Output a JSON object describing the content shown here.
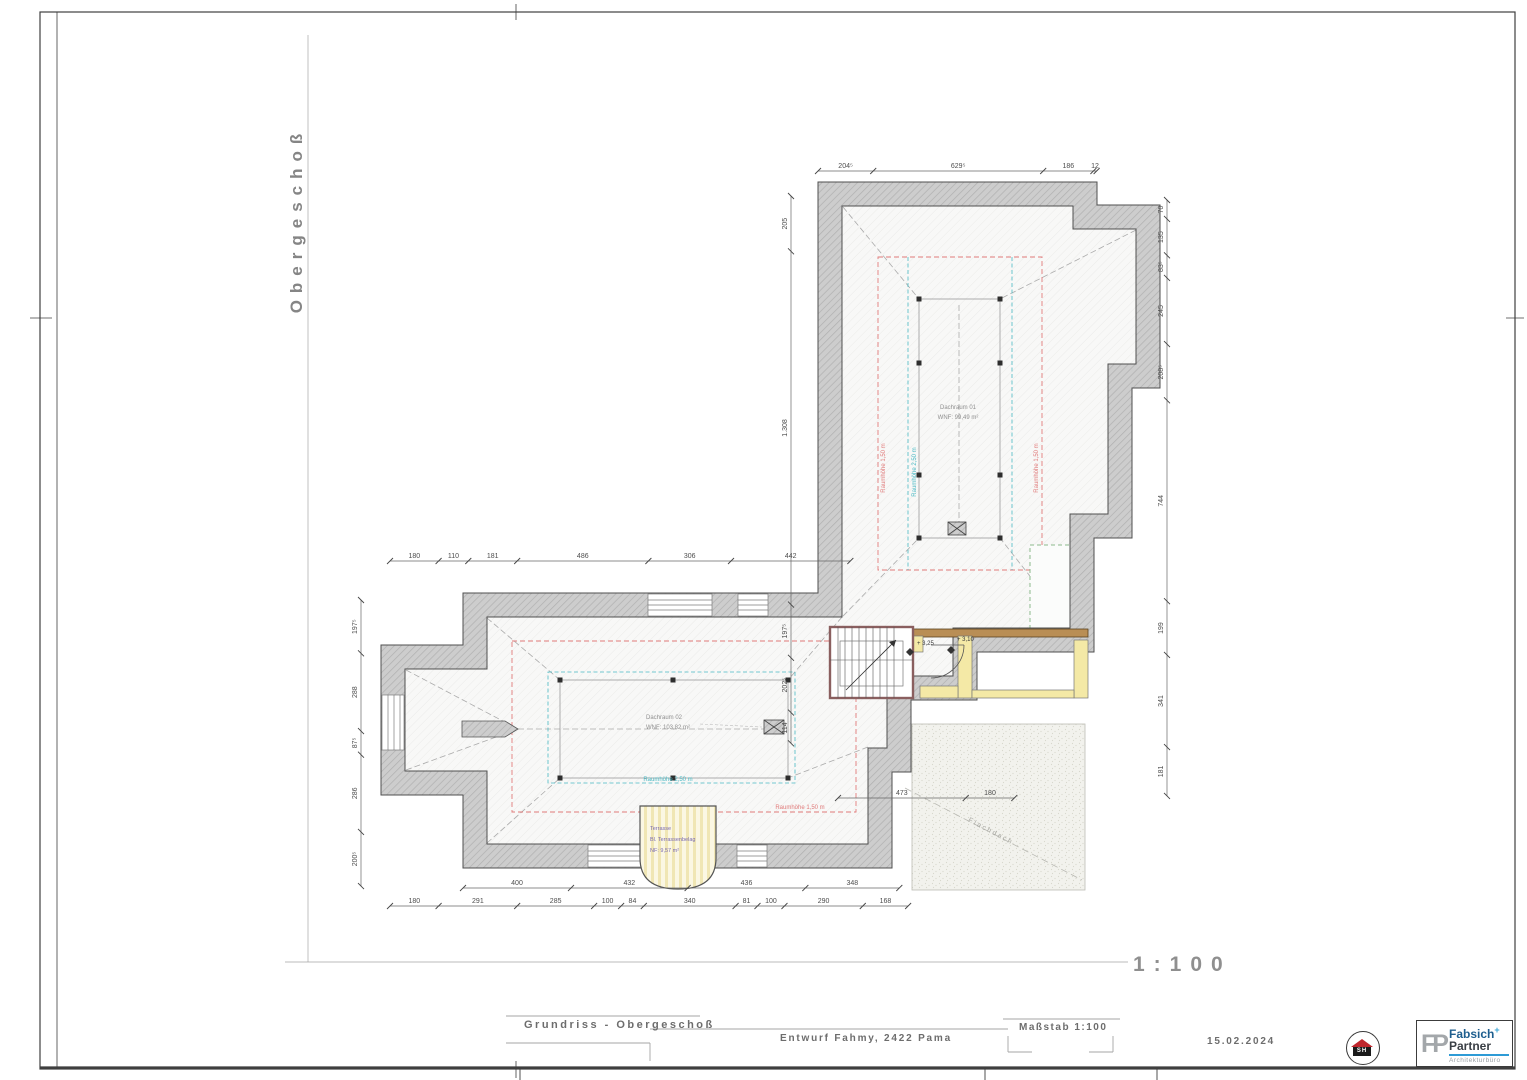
{
  "sheet": {
    "side_title": "Obergeschoß",
    "scale_display": "1:100"
  },
  "title_block": {
    "drawing_title": "Grundriss - Obergeschoß",
    "project": "Entwurf Fahmy, 2422 Pama",
    "scale_label": "Maßstab 1:100",
    "date": "15.02.2024",
    "stamp_text": "SH",
    "logo": {
      "monogram": "FP",
      "name": "Fabsich",
      "plus": "+",
      "name2": "Partner",
      "subtitle": "Architekturbüro"
    }
  },
  "plan": {
    "rooms": [
      {
        "name": "Dachraum 01",
        "area": "WNF: 99,49 m²"
      },
      {
        "name": "Dachraum 02",
        "area": "WNF: 103,82 m²"
      },
      {
        "name": "Terrasse",
        "line2": "Bl. Terrassenbelag",
        "line3": "NF: 9,57 m²"
      }
    ],
    "annotations": {
      "rh150": "Raumhöhe 1,50 m",
      "rh250": "Raumhöhe 2,50 m",
      "level_a": "+ 3,25",
      "level_b": "+ 3,10",
      "flat_roof": "Flachdach"
    },
    "dim_chains": [
      {
        "id": "top",
        "segs": [
          {
            "t": "204⁵",
            "v": 204.5
          },
          {
            "t": "629⁵",
            "v": 629.5
          },
          {
            "t": "186",
            "v": 186
          },
          {
            "t": "12",
            "v": 12
          }
        ]
      },
      {
        "id": "left_v",
        "segs": [
          {
            "t": "205",
            "v": 205
          },
          {
            "t": "1.308",
            "v": 1308
          },
          {
            "t": "197⁵",
            "v": 197.5
          },
          {
            "t": "202⁵",
            "v": 202.5
          },
          {
            "t": "114",
            "v": 114
          }
        ]
      },
      {
        "id": "right_v",
        "segs": [
          {
            "t": "70",
            "v": 70
          },
          {
            "t": "135",
            "v": 135
          },
          {
            "t": "83⁵",
            "v": 83.5
          },
          {
            "t": "245",
            "v": 245
          },
          {
            "t": "208⁵",
            "v": 208.5
          },
          {
            "t": "744",
            "v": 744
          },
          {
            "t": "199",
            "v": 199
          },
          {
            "t": "341",
            "v": 341
          },
          {
            "t": "181",
            "v": 181
          }
        ]
      },
      {
        "id": "mid_h",
        "segs": [
          {
            "t": "180",
            "v": 180
          },
          {
            "t": "110",
            "v": 110
          },
          {
            "t": "181",
            "v": 181
          },
          {
            "t": "486",
            "v": 486
          },
          {
            "t": "306",
            "v": 306
          },
          {
            "t": "442",
            "v": 442
          }
        ]
      },
      {
        "id": "west_v",
        "segs": [
          {
            "t": "197⁵",
            "v": 197.5
          },
          {
            "t": "288",
            "v": 288
          },
          {
            "t": "87⁵",
            "v": 87.5
          },
          {
            "t": "286",
            "v": 286
          },
          {
            "t": "200⁵",
            "v": 200.5
          }
        ]
      },
      {
        "id": "stair_h",
        "segs": [
          {
            "t": "473",
            "v": 473
          },
          {
            "t": "180",
            "v": 180
          }
        ]
      },
      {
        "id": "bottom1",
        "segs": [
          {
            "t": "400",
            "v": 400
          },
          {
            "t": "432",
            "v": 432
          },
          {
            "t": "436",
            "v": 436
          },
          {
            "t": "348",
            "v": 348
          }
        ]
      },
      {
        "id": "bottom2",
        "segs": [
          {
            "t": "180",
            "v": 180
          },
          {
            "t": "291",
            "v": 291
          },
          {
            "t": "285",
            "v": 285
          },
          {
            "t": "100",
            "v": 100
          },
          {
            "t": "84",
            "v": 84
          },
          {
            "t": "340",
            "v": 340
          },
          {
            "t": "81",
            "v": 81
          },
          {
            "t": "100",
            "v": 100
          },
          {
            "t": "290",
            "v": 290
          },
          {
            "t": "168",
            "v": 168
          }
        ]
      }
    ]
  }
}
